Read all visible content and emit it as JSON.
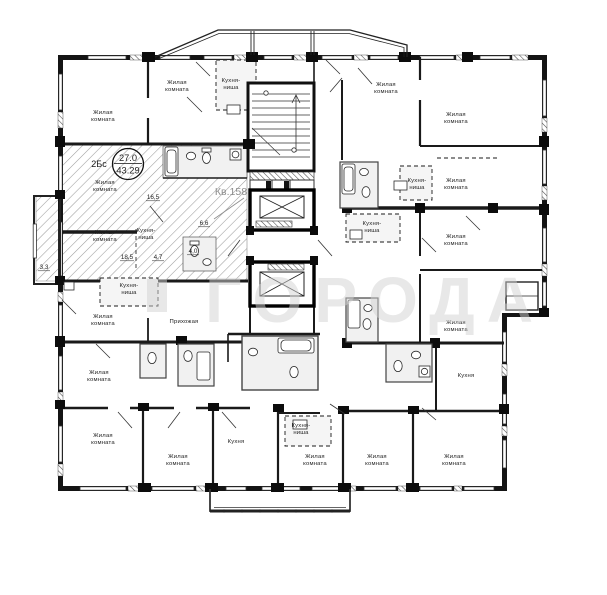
{
  "watermark": {
    "text": "ГОРОДА"
  },
  "highlighted_apartment": {
    "unit_label": "Кв.158",
    "badge": {
      "type": "2Бс",
      "living_area": "27.0",
      "total_area": "43.29"
    },
    "area_labels": {
      "room_top": "16,5",
      "room_bottom": "18,5",
      "kitchen_niche": "4,7",
      "hallway": "6,6",
      "bathroom": "4,0",
      "balcony": "3,3"
    }
  },
  "rooms": [
    {
      "name": "living-top-left",
      "lines": [
        "Жилая",
        "комната"
      ]
    },
    {
      "name": "living-top-mid",
      "lines": [
        "Жилая",
        "комната"
      ]
    },
    {
      "name": "kitchen-niche-top",
      "lines": [
        "Кухня-",
        "ниша"
      ]
    },
    {
      "name": "living-top-right-a",
      "lines": [
        "Жилая",
        "комната"
      ]
    },
    {
      "name": "living-top-right-b",
      "lines": [
        "Жилая",
        "комната"
      ]
    },
    {
      "name": "kitchen-niche-right-a",
      "lines": [
        "Кухня-",
        "ниша"
      ]
    },
    {
      "name": "living-right-a",
      "lines": [
        "Жилая",
        "комната"
      ]
    },
    {
      "name": "kitchen-niche-right-b",
      "lines": [
        "Кухня-",
        "ниша"
      ]
    },
    {
      "name": "living-right-b",
      "lines": [
        "Жилая",
        "комната"
      ]
    },
    {
      "name": "living-right-c",
      "lines": [
        "Жилая",
        "комната"
      ]
    },
    {
      "name": "kitchen-right",
      "lines": [
        "Кухня"
      ]
    },
    {
      "name": "living-bottom-a",
      "lines": [
        "Жилая",
        "комната"
      ]
    },
    {
      "name": "kitchen-niche-bottom",
      "lines": [
        "Кухня-",
        "ниша"
      ]
    },
    {
      "name": "living-bottom-b",
      "lines": [
        "Жилая",
        "комната"
      ]
    },
    {
      "name": "living-bottom-c",
      "lines": [
        "Жилая",
        "комната"
      ]
    },
    {
      "name": "kitchen-bottom",
      "lines": [
        "Кухня"
      ]
    },
    {
      "name": "living-bottom-d",
      "lines": [
        "Жилая",
        "комната"
      ]
    },
    {
      "name": "living-bottom-left",
      "lines": [
        "Жилая",
        "комната"
      ]
    },
    {
      "name": "living-left-a",
      "lines": [
        "Жилая",
        "комната"
      ]
    },
    {
      "name": "living-left-b",
      "lines": [
        "Жилая",
        "комната"
      ]
    },
    {
      "name": "hallway",
      "lines": [
        "Прихожая"
      ]
    },
    {
      "name": "kitchen-niche-left",
      "lines": [
        "Кухня-",
        "ниша"
      ]
    },
    {
      "name": "apt158-living-a",
      "lines": [
        "Жилая",
        "комната"
      ]
    },
    {
      "name": "apt158-living-b",
      "lines": [
        "Жилая",
        "комната"
      ]
    },
    {
      "name": "apt158-kitchen-niche",
      "lines": [
        "Кухня-",
        "ниша"
      ]
    }
  ]
}
